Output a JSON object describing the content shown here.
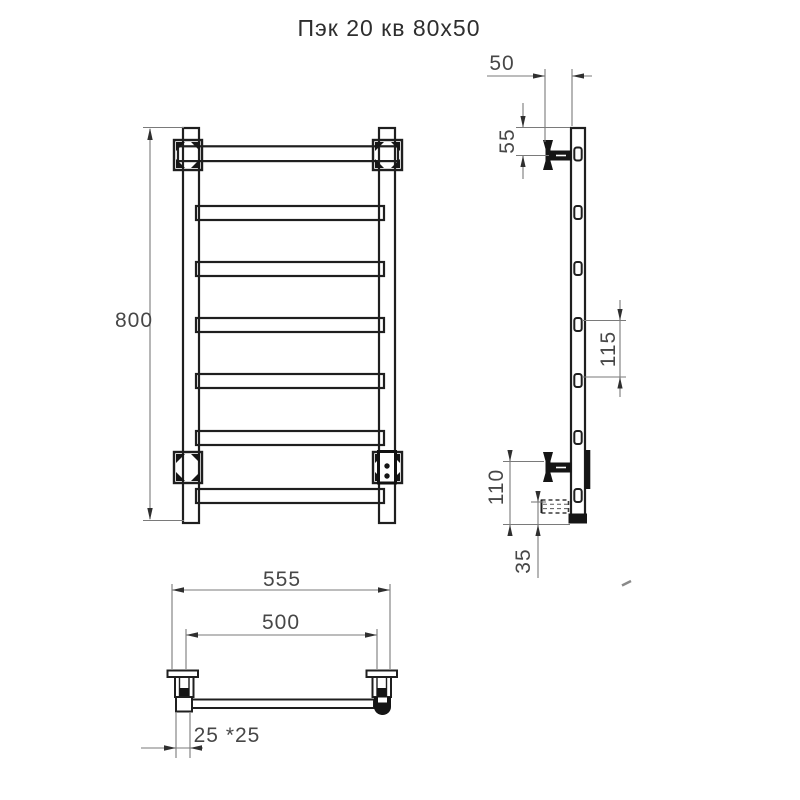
{
  "title": "Пэк 20 кв 80х50",
  "dimensions": {
    "front_height": "800",
    "side_wall_offset": "50",
    "side_top_to_bracket": "55",
    "side_rung_spacing": "115",
    "side_bracket_to_bottom": "110",
    "side_cable_to_bottom": "35",
    "bottom_overall_width": "555",
    "bottom_mount_spacing": "500",
    "bottom_profile_size": "25 *25"
  }
}
